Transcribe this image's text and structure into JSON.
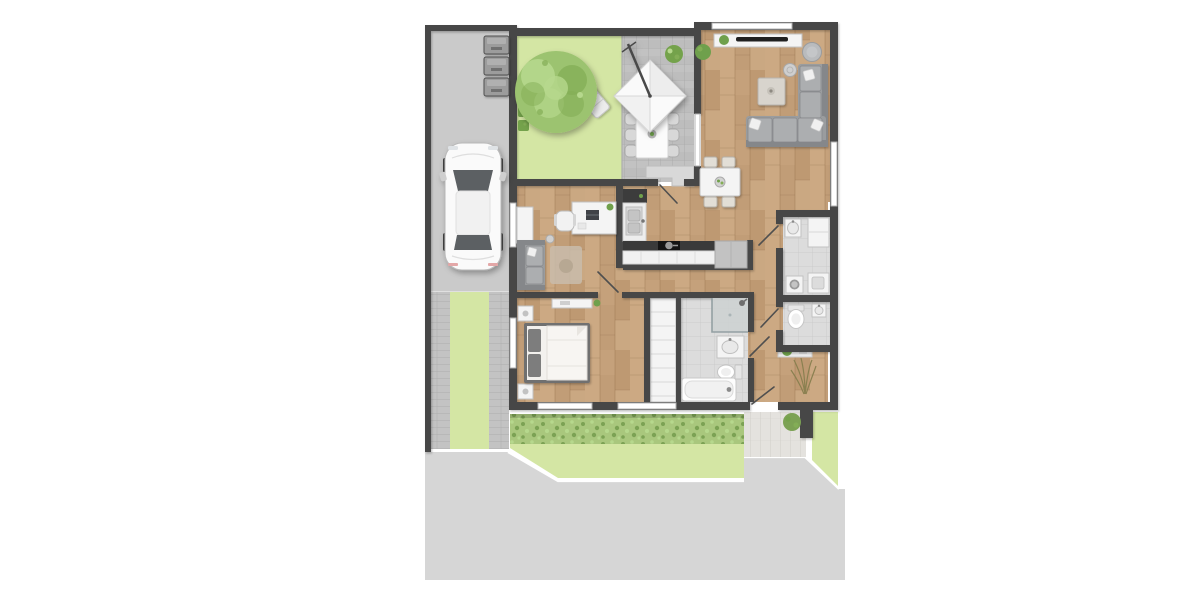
{
  "meta": {
    "app": "floor-plan-render",
    "description": "Top-down rendered apartment floor plan with driveway, parked car, front garden, terrace and furnished interior"
  },
  "colors": {
    "background": "#ffffff",
    "sidewalk": "#d6d6d6",
    "driveway": "#cacaca",
    "trackPaver": "#c3c3c3",
    "wall": "#474747",
    "wood": "#c5a17b",
    "woodLight": "#d3b18b",
    "woodDark": "#ae8a61",
    "lawn": "#d4e6a4",
    "hedge": "#a9c77d",
    "hedgeDark": "#7ca254",
    "treeMain": "#9cc36f",
    "treeLight": "#b6d88d",
    "treeDark": "#83ad56",
    "bush": "#74a24b",
    "accent": "#6fa04c",
    "terracePaver": "#bdbdbd",
    "paverLine": "#a7a7a7",
    "tile": "#dcdcdc",
    "tileLine": "#c8c8c8",
    "white": "#ffffff",
    "furn": "#f4f4f4",
    "furnStroke": "#c2c2c2",
    "sofa": "#9a9c9e",
    "sofaDark": "#85878a",
    "sofaLight": "#acaeb0",
    "rug": "#c9bcab",
    "counterDark": "#3a3a3a",
    "appliance": "#c6c6c6",
    "carBody": "#fafafa",
    "carGlass": "#5c6063",
    "patio": "#e4e2de",
    "patioLine": "#d1cec8",
    "olive": "#8a8050",
    "step": "#d8d8d8"
  },
  "rooms": [
    {
      "id": "living-room",
      "name": "Living room",
      "floor": "wood"
    },
    {
      "id": "dining-area",
      "name": "Dining area",
      "floor": "wood"
    },
    {
      "id": "kitchen",
      "name": "Kitchen",
      "floor": "wood"
    },
    {
      "id": "home-office",
      "name": "Home office",
      "floor": "wood"
    },
    {
      "id": "hallway",
      "name": "Hallway",
      "floor": "wood"
    },
    {
      "id": "bedroom",
      "name": "Bedroom",
      "floor": "wood"
    },
    {
      "id": "wardrobe",
      "name": "Built-in wardrobe",
      "floor": "cabinet"
    },
    {
      "id": "bathroom",
      "name": "Bathroom",
      "floor": "tile"
    },
    {
      "id": "utility-room",
      "name": "Utility room",
      "floor": "tile"
    },
    {
      "id": "wc",
      "name": "Guest WC",
      "floor": "tile"
    },
    {
      "id": "entrance",
      "name": "Entrance",
      "floor": "step"
    },
    {
      "id": "terrace",
      "name": "Terrace",
      "floor": "pavers"
    },
    {
      "id": "garden",
      "name": "Front garden",
      "floor": "lawn"
    }
  ],
  "site": {
    "features": [
      {
        "id": "driveway",
        "name": "Driveway"
      },
      {
        "id": "car",
        "name": "Parked car"
      },
      {
        "id": "waste-bins",
        "name": "Waste bins",
        "count": 3
      },
      {
        "id": "tree",
        "name": "Garden tree"
      },
      {
        "id": "sun-lounger",
        "name": "Sun lounger"
      },
      {
        "id": "parasol",
        "name": "Parasol"
      },
      {
        "id": "outdoor-dining",
        "name": "Outdoor dining set",
        "chairs": 6
      },
      {
        "id": "hedge",
        "name": "Hedge"
      },
      {
        "id": "lawn",
        "name": "Lawn"
      },
      {
        "id": "walkway",
        "name": "Wheel-track walkway"
      },
      {
        "id": "patio",
        "name": "Rear patio"
      },
      {
        "id": "sidewalk",
        "name": "Sidewalk"
      }
    ]
  },
  "furniture": {
    "living_room": [
      "sideboard",
      "tv",
      "plant",
      "pouf",
      "side-table",
      "coffee-table",
      "corner-sofa",
      "pillows"
    ],
    "dining": [
      "dining-table",
      "chairs-4",
      "fruit-bowl"
    ],
    "kitchen": [
      "sink-unit",
      "tall-cabinet",
      "countertop",
      "hob-with-pot",
      "base-cabinets",
      "end-cabinet"
    ],
    "office": [
      "desk",
      "laptop",
      "office-chair",
      "cabinet",
      "sofa",
      "rug",
      "floor-lamp",
      "plant"
    ],
    "bedroom": [
      "double-bed",
      "pillows-2",
      "nightstands-2",
      "sideboard",
      "plant"
    ],
    "bathroom": [
      "shower",
      "washbasin",
      "toilet",
      "bathtub"
    ],
    "utility": [
      "washbasin",
      "counter",
      "washer",
      "dryer"
    ],
    "wc": [
      "toilet",
      "washbasin",
      "shelf",
      "plant"
    ]
  }
}
